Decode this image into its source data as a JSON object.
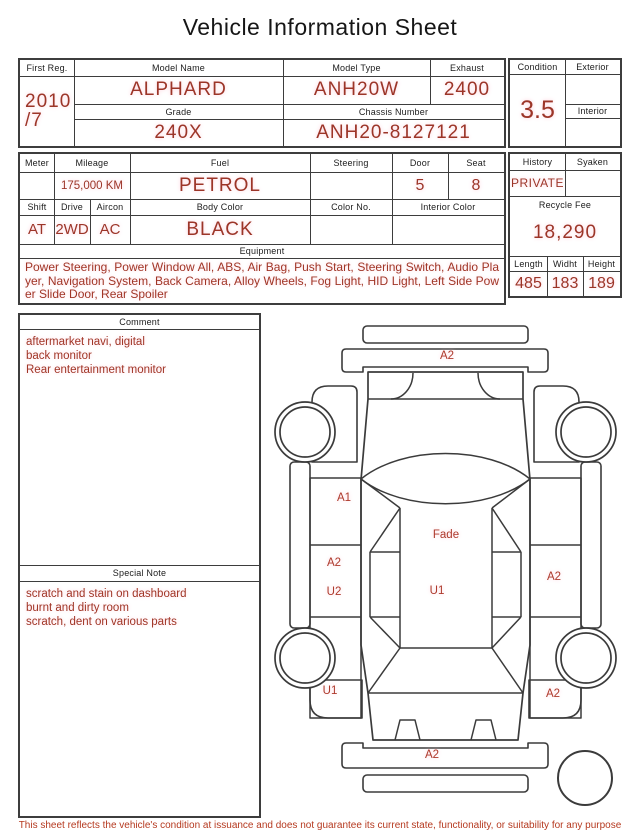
{
  "title": "Vehicle Information Sheet",
  "info1": {
    "first_reg_label": "First Reg.",
    "first_reg_value": "2010\n/7",
    "model_name_label": "Model Name",
    "model_name": "ALPHARD",
    "model_type_label": "Model Type",
    "model_type": "ANH20W",
    "exhaust_label": "Exhaust",
    "exhaust": "2400",
    "grade_label": "Grade",
    "grade": "240X",
    "chassis_label": "Chassis Number",
    "chassis": "ANH20-8127121",
    "condition_label": "Condition",
    "condition": "3.5",
    "exterior_label": "Exterior",
    "exterior": "",
    "interior_label": "Interior",
    "interior": ""
  },
  "info2": {
    "meter_label": "Meter",
    "meter": "",
    "mileage_label": "Mileage",
    "mileage": "175,000 KM",
    "fuel_label": "Fuel",
    "fuel": "PETROL",
    "steering_label": "Steering",
    "steering": "",
    "door_label": "Door",
    "door": "5",
    "seat_label": "Seat",
    "seat": "8",
    "shift_label": "Shift",
    "shift": "AT",
    "drive_label": "Drive",
    "drive": "2WD",
    "aircon_label": "Aircon",
    "aircon": "AC",
    "body_color_label": "Body Color",
    "body_color": "BLACK",
    "color_no_label": "Color No.",
    "color_no": "",
    "interior_color_label": "Interior Color",
    "interior_color": "",
    "equipment_label": "Equipment",
    "equipment": "Power Steering, Power Window All, ABS, Air Bag, Push Start, Steering Switch, Audio Player, Navigation System, Back Camera, Alloy Wheels, Fog Light, HID Light, Left Side Power Slide Door, Rear Spoiler",
    "history_label": "History",
    "history": "PRIVATE",
    "syaken_label": "Syaken",
    "syaken": "",
    "recycle_label": "Recycle Fee",
    "recycle_fee": "18,290",
    "length_label": "Length",
    "length": "485",
    "width_label": "Widht",
    "width": "183",
    "height_label": "Height",
    "height": "189"
  },
  "comment": {
    "label": "Comment",
    "text": "aftermarket navi, digital\nback monitor\nRear entertainment monitor"
  },
  "special_note": {
    "label": "Special Note",
    "text": "scratch and stain on dashboard\nburnt and dirty room\nscratch, dent on various parts"
  },
  "diagram": {
    "marks": [
      {
        "part": "front-bumper",
        "text": "A2"
      },
      {
        "part": "left-front-door",
        "text": "A1"
      },
      {
        "part": "roof-front",
        "text": "Fade"
      },
      {
        "part": "left-slide-door-upper",
        "text": "A2"
      },
      {
        "part": "left-slide-door-lower",
        "text": "U2"
      },
      {
        "part": "roof-center",
        "text": "U1"
      },
      {
        "part": "right-slide-door",
        "text": "A2"
      },
      {
        "part": "left-rear-quarter",
        "text": "U1"
      },
      {
        "part": "right-rear-quarter",
        "text": "A2"
      },
      {
        "part": "rear-bumper",
        "text": "A2"
      }
    ]
  },
  "footer": {
    "disclaimer": "This sheet reflects the vehicle's condition at issuance and does not guarantee its current state, functionality, or suitability for any purpose"
  },
  "colors": {
    "value_red": "#9c3528",
    "line": "#3d3d3d"
  }
}
